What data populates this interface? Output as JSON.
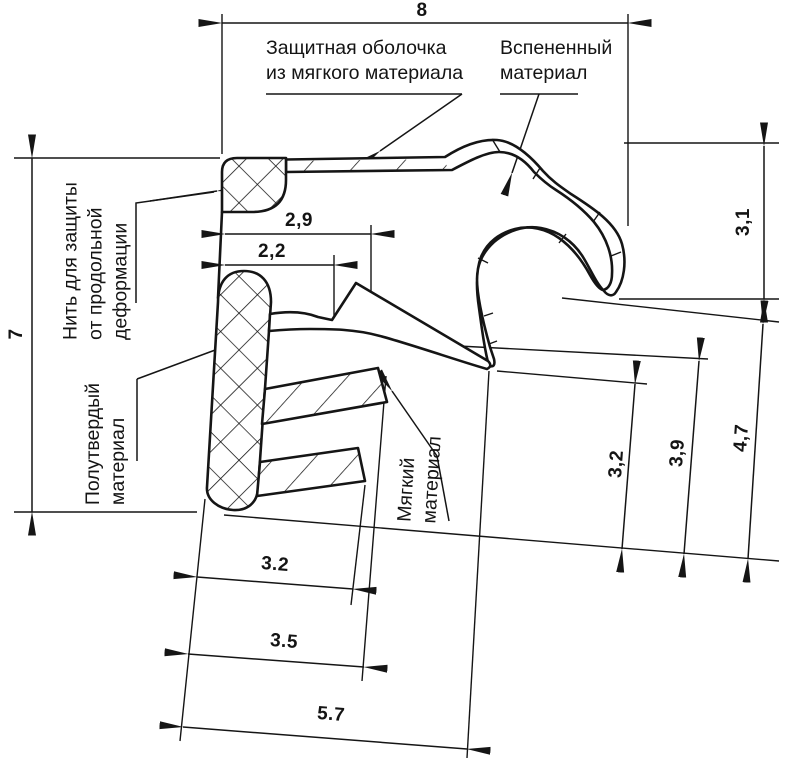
{
  "drawing": {
    "title": "seal-profile-cross-section",
    "colors": {
      "line": "#151515",
      "background": "#ffffff"
    },
    "labels": {
      "protective_shell": {
        "line1": "Защитная оболочка",
        "line2": "из мягкого материала"
      },
      "foamed": {
        "line1": "Вспененный",
        "line2": "материал"
      },
      "thread": {
        "line1": "Нить для защиты",
        "line2": "от продольной",
        "line3": "деформации"
      },
      "semi_hard": {
        "line1": "Полутвердый",
        "line2": "материал"
      },
      "soft": {
        "line1": "Мягкий",
        "line2": "материал"
      }
    },
    "dimensions": {
      "overall_width": "8",
      "overall_height": "7",
      "hook_height": "3,1",
      "top_offset_outer": "2,9",
      "top_offset_inner": "2,2",
      "right_height_small": "3,2",
      "right_height_mid": "3,9",
      "right_height_large": "4,7",
      "bottom_width_small": "3.2",
      "bottom_width_mid": "3.5",
      "bottom_width_large": "5.7"
    }
  }
}
